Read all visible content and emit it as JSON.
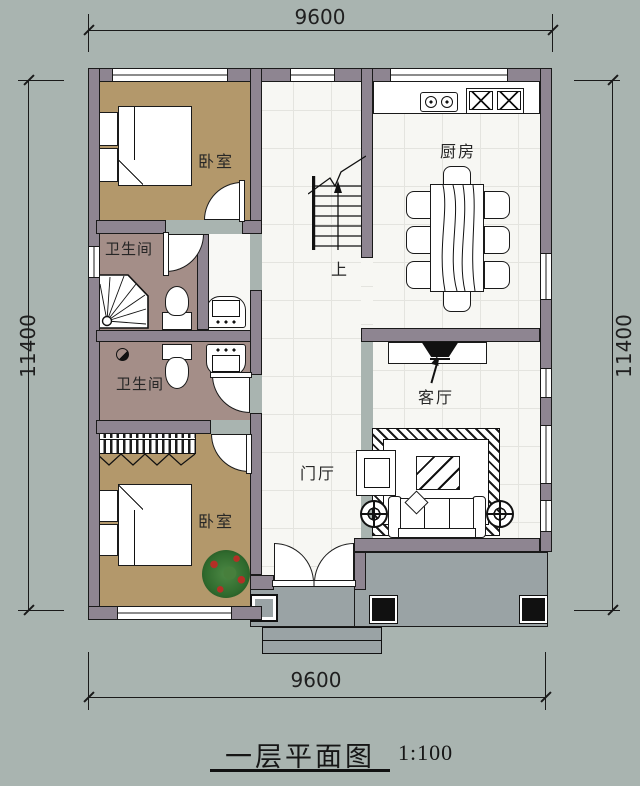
{
  "title": {
    "text": "一层平面图",
    "scale": "1:100"
  },
  "dimensions": {
    "top": "9600",
    "bottom": "9600",
    "left": "11400",
    "right": "11400"
  },
  "rooms": {
    "bedroom_top": "卧室",
    "bathroom_top": "卫生间",
    "bathroom_bottom": "卫生间",
    "bedroom_bottom": "卧室",
    "kitchen": "厨房",
    "living_room": "客厅",
    "foyer": "门厅"
  },
  "stairs": {
    "up_label": "上"
  },
  "colors": {
    "bg": "#a9b4b0",
    "wall": "#8e8591",
    "line": "#1a1a1a",
    "bedroom_floor": "#b3986b",
    "bath_floor": "#a48e88",
    "tile_floor": "#f7f7f3",
    "tile_line": "#e4e4df",
    "porch_floor": "#9aa3a5",
    "plant_green": "#2f6a2d",
    "plant_berry": "#b52f26"
  }
}
